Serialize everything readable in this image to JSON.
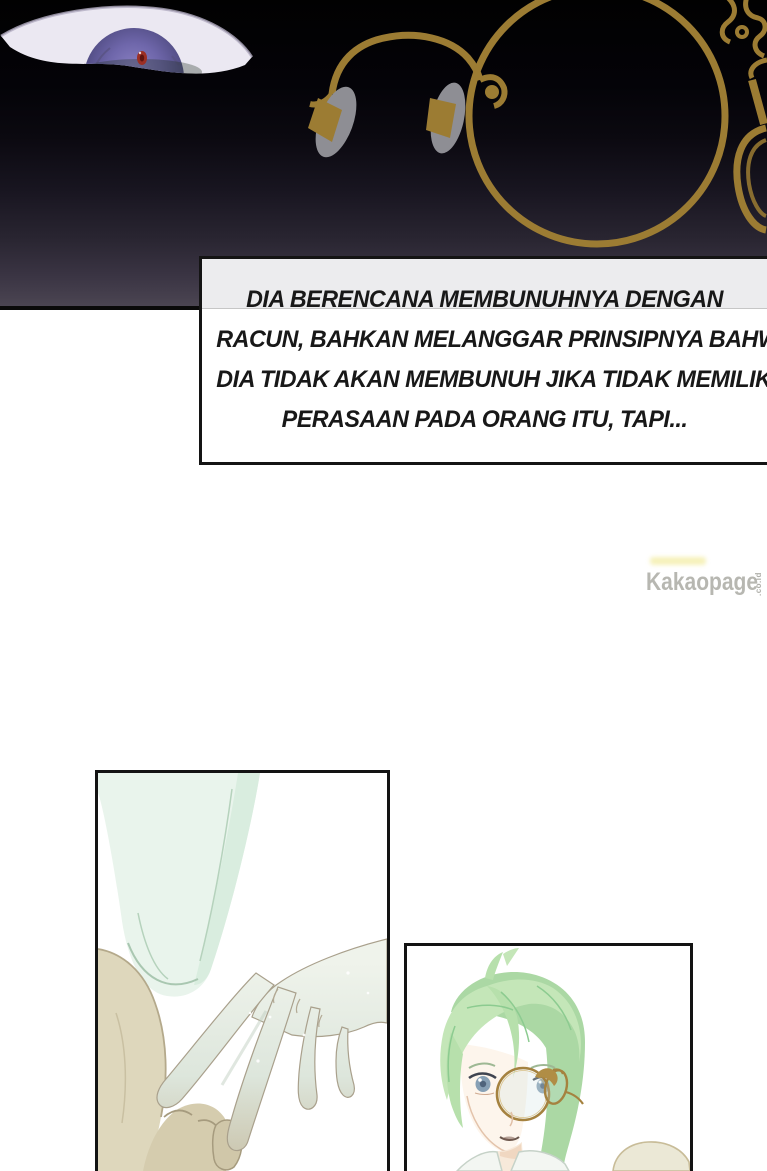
{
  "narration": {
    "lines": [
      "DIA BERENCANA MEMBUNUHNYA DENGAN",
      "RACUN, BAHKAN MELANGGAR PRINSIPNYA BAHWA",
      "DIA TIDAK AKAN MEMBUNUH JIKA TIDAK MEMILIKI",
      "PERASAAN PADA ORANG ITU, TAPI..."
    ]
  },
  "watermark": {
    "text": "Kakaopage",
    "suffix": ".co.id"
  },
  "colors": {
    "glasses_gold": "#9c7c33",
    "iris_purple": "#6e66aa",
    "pupil_red": "#9c2f24",
    "hair_green": "#c4e6b8",
    "sleeve_mint": "#e9f4ec",
    "sleeve_tan": "#ded7bc",
    "panel_border": "#131313",
    "watermark_gray": "#b7b7b1",
    "backdrop_top": "#010101",
    "backdrop_bottom": "#4b4552"
  }
}
